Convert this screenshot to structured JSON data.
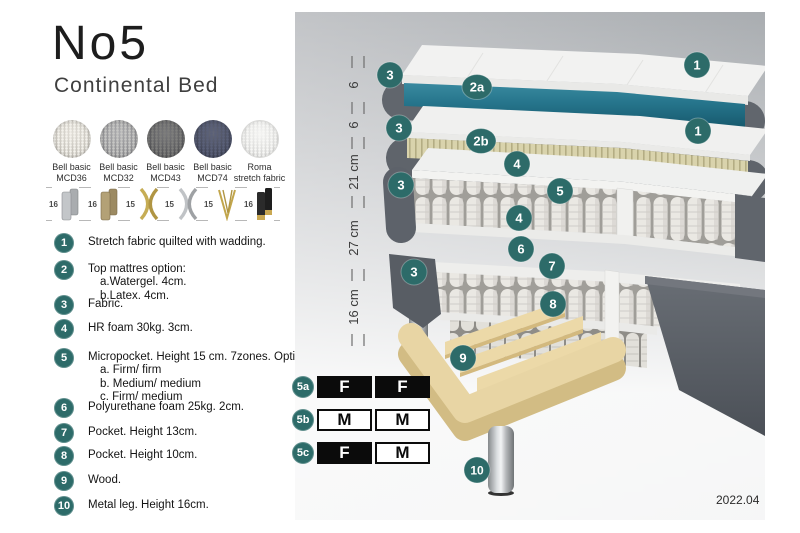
{
  "product": {
    "title": "No5",
    "subtitle": "Continental Bed"
  },
  "fabric_swatches": [
    {
      "line1": "Bell basic",
      "line2": "MCD36",
      "color": "#d9d5cc"
    },
    {
      "line1": "Bell basic",
      "line2": "MCD32",
      "color": "#97979a"
    },
    {
      "line1": "Bell basic",
      "line2": "MCD43",
      "color": "#57575a"
    },
    {
      "line1": "Bell basic",
      "line2": "MCD74",
      "color": "#3c4157"
    },
    {
      "line1": "Roma",
      "line2": "stretch fabric",
      "color": "#f1f1ef"
    }
  ],
  "leg_options": [
    {
      "height": "16",
      "finish": "silver-cylinder"
    },
    {
      "height": "16",
      "finish": "bronze-cylinder"
    },
    {
      "height": "15",
      "finish": "gold-twisted"
    },
    {
      "height": "15",
      "finish": "silver-twisted"
    },
    {
      "height": "15",
      "finish": "gold-hairpin"
    },
    {
      "height": "16",
      "finish": "black-gold-tip"
    }
  ],
  "legend": {
    "items": [
      {
        "num": "1",
        "text": "Stretch fabric quilted with wadding."
      },
      {
        "num": "2",
        "text": "Top mattres option:",
        "sub": [
          "a.Watergel. 4cm.",
          "b.Latex. 4cm."
        ]
      },
      {
        "num": "3",
        "text": "Fabric."
      },
      {
        "num": "4",
        "text": "HR foam 30kg. 3cm."
      },
      {
        "num": "5",
        "text": "Micropocket. Height 15 cm. 7zones. Option:",
        "sub": [
          "a. Firm/ firm",
          "b. Medium/ medium",
          "c. Firm/ medium"
        ]
      },
      {
        "num": "6",
        "text": "Polyurethane foam 25kg. 2cm."
      },
      {
        "num": "7",
        "text": "Pocket. Height 13cm."
      },
      {
        "num": "8",
        "text": "Pocket. Height 10cm."
      },
      {
        "num": "9",
        "text": "Wood."
      },
      {
        "num": "10",
        "text": "Metal leg. Height 16cm."
      }
    ]
  },
  "diagram": {
    "ruler": [
      "6",
      "6",
      "21 cm",
      "27 cm",
      "16 cm"
    ],
    "badges": [
      "3",
      "1",
      "2a",
      "3",
      "2b",
      "1",
      "4",
      "3",
      "5",
      "4",
      "6",
      "3",
      "7",
      "8",
      "9",
      "10"
    ],
    "badge_color": "#2d6b69",
    "topper_core_color": "#2a7a90",
    "latex_color": "#d9d3ac",
    "fabric_color": "#5f646b",
    "wood_color": "#e8d5a4"
  },
  "firmness_table": {
    "rows": [
      {
        "label": "5a",
        "cells": [
          {
            "letter": "F",
            "filled": true
          },
          {
            "letter": "F",
            "filled": true
          }
        ]
      },
      {
        "label": "5b",
        "cells": [
          {
            "letter": "M",
            "filled": false
          },
          {
            "letter": "M",
            "filled": false
          }
        ]
      },
      {
        "label": "5c",
        "cells": [
          {
            "letter": "F",
            "filled": true
          },
          {
            "letter": "M",
            "filled": false
          }
        ]
      }
    ]
  },
  "version": "2022.04"
}
